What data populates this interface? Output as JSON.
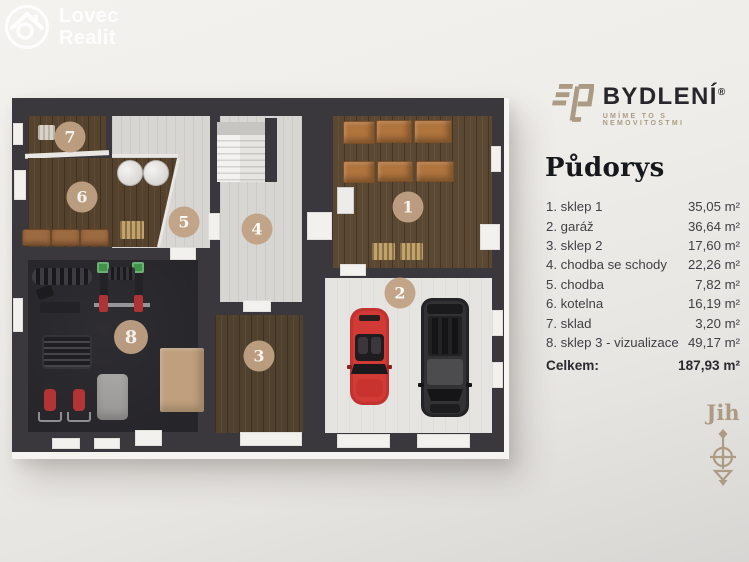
{
  "watermark": {
    "line1": "Lovec",
    "line2": "Realit"
  },
  "brand": {
    "name": "BYDLENÍ",
    "reg": "®",
    "tagline": "UMÍME TO S NEMOVITOSTMI"
  },
  "panel": {
    "title": "Půdorys",
    "rooms": [
      {
        "num": "1",
        "label": "1. sklep 1",
        "area": "35,05 m²"
      },
      {
        "num": "2",
        "label": "2. garáž",
        "area": "36,64 m²"
      },
      {
        "num": "3",
        "label": "3. sklep 2",
        "area": "17,60 m²"
      },
      {
        "num": "4",
        "label": "4. chodba se schody",
        "area": "22,26 m²"
      },
      {
        "num": "5",
        "label": "5. chodba",
        "area": "7,82 m²"
      },
      {
        "num": "6",
        "label": "6. kotelna",
        "area": "16,19 m²"
      },
      {
        "num": "7",
        "label": "7. sklad",
        "area": "3,20 m²"
      },
      {
        "num": "8",
        "label": "8. sklep 3 - vizualizace",
        "area": "49,17 m²"
      }
    ],
    "total_label": "Celkem:",
    "total_value": "187,93 m²"
  },
  "compass": {
    "label": "Jih",
    "direction": "south"
  },
  "colors": {
    "accent_tan": "#c1a285",
    "logo_tan": "#ab9b84",
    "wall": "#3a383c",
    "list_text": "#3f3f45",
    "car_red": "#c23330",
    "car_black": "#2e2d30"
  }
}
